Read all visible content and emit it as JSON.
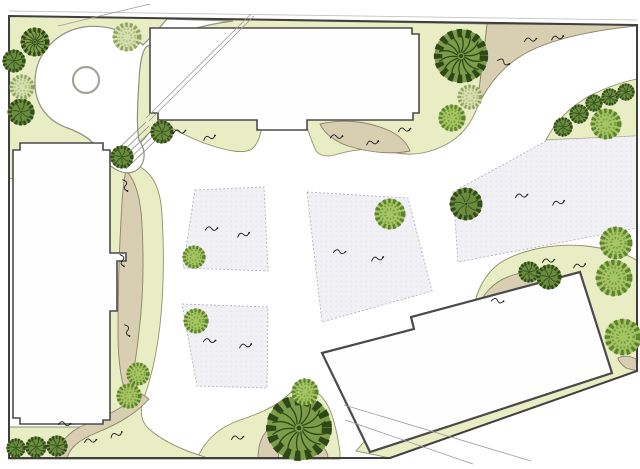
{
  "canvas": {
    "width": 640,
    "height": 469,
    "background": "#ffffff"
  },
  "palette": {
    "lawn": "#e9edc4",
    "lawnStroke": "#8d9168",
    "tan": "#d8ceb1",
    "tanStroke": "#8a8268",
    "parcelFill": "#f0f0f5",
    "parcelStroke": "#b3b3bd",
    "parcelDot": "#d7d7e1",
    "buildingFill": "#fefefe",
    "buildingStroke": "#4a4a4a",
    "boundary": "#3f3f3f",
    "lightLine": "#c4c4c4",
    "thinLine": "#9a9a9a",
    "plazaFill": "#ffffff",
    "plazaStroke": "#8f9180",
    "ringStroke": "#a5a49a",
    "symbol": "#1c1c1c"
  },
  "site": {
    "boundary_points": "9,16 637,25 637,371 390,458 9,458",
    "top_light_line": {
      "x1": 9,
      "y1": 11,
      "x2": 637,
      "y2": 20
    }
  },
  "lawns": [
    {
      "name": "lawn-top",
      "d": "M9,16 L487,24 C484,52 480,80 477,108 C470,127 457,140 441,147 C426,154 409,156 392,152 C374,148 355,149 338,154 C329,157 321,157 316,151 C311,140 308,130 305,122 L305,112 L262,112 C263,128 260,142 252,149 C244,154 230,151 216,147 C199,142 184,135 170,127 L163,122 L149,133 C139,147 125,156 109,161 C79,170 45,172 9,179 Z"
    },
    {
      "name": "lawn-arc-right",
      "d": "M546,140 C557,118 577,100 602,90 C614,85 627,81 637,79 L637,136 Z"
    },
    {
      "name": "lawn-band-right",
      "d": "M472,318 C474,296 483,275 500,263 C522,249 556,243 586,246 C612,249 630,255 637,261 L637,371 L390,458 L356,451 Z"
    },
    {
      "name": "lawn-mound-bottom",
      "d": "M197,459 C205,439 220,427 240,420 C258,414 275,407 287,396 C294,389 301,385 308,387 C317,390 325,399 330,410 C335,422 338,438 340,452 L340,459 Z"
    },
    {
      "name": "lawn-left-cband",
      "d": "M104,163 C119,157 134,161 146,171 C157,181 161,196 162,215 C164,250 164,290 160,325 C157,352 151,378 144,398 C140,410 140,420 148,428 C162,441 182,450 205,457 L205,459 L9,459 L9,427 L104,427 Z"
    }
  ],
  "tan_paths": [
    {
      "name": "tan-sweep-topright",
      "d": "M487,24 C484,52 480,80 477,108 C488,84 505,64 528,52 C557,37 597,30 637,26 L637,25 Z"
    },
    {
      "name": "tan-leaf-under-building",
      "d": "M320,124 C345,118 370,122 390,131 C400,136 407,143 410,151 C390,155 368,152 348,146 C334,141 324,133 320,124 Z"
    },
    {
      "name": "tan-leaf-left",
      "d": "M126,170 C136,181 141,200 142,225 C144,262 143,300 139,332 C136,360 132,382 127,397 C121,382 118,360 118,332 C118,295 119,255 121,220 C122,200 123,184 126,170 Z"
    },
    {
      "name": "tan-ribbon-bottomleft",
      "d": "M55,459 C58,444 68,432 84,425 C105,417 125,407 140,393 L149,399 C136,414 116,425 96,433 C79,440 69,448 67,459 Z"
    },
    {
      "name": "tan-mound-left",
      "d": "M258,459 C258,445 262,434 270,428 C277,433 280,443 279,453 L278,459 Z"
    },
    {
      "name": "tan-mound-right",
      "d": "M310,459 C311,450 315,444 321,446 C326,449 328,454 328,459 Z"
    },
    {
      "name": "tan-corner-wedge",
      "d": "M618,358 C624,355 630,356 636,359 L637,371 L626,368 C621,364 618,361 618,358 Z"
    },
    {
      "name": "tan-crescent-right",
      "d": "M476,313 C481,295 493,282 510,276 C530,269 548,271 560,279 L562,291 C541,283 516,286 499,297 C489,303 481,308 476,313 Z"
    }
  ],
  "plaza": {
    "blob_d": "M167,19 C158,30 150,38 143,45 C128,31 105,24 84,27 C58,31 36,52 35,80 C34,104 47,120 65,127 C82,133 93,140 98,150 C103,160 110,167 119,171 C129,175 138,172 142,164 C146,156 144,147 139,140 C136,125 138,100 139,80 C140,62 142,52 146,47 C165,36 200,25 233,21 Z",
    "ring": {
      "cx": 86,
      "cy": 80,
      "r": 13
    }
  },
  "parcels": [
    {
      "name": "parcel-1",
      "points": "195,190 264,187 268,271 183,268"
    },
    {
      "name": "parcel-2",
      "points": "182,304 268,307 267,388 197,386"
    },
    {
      "name": "parcel-3",
      "points": "307,192 408,198 432,291 322,322"
    },
    {
      "name": "parcel-4",
      "points": "453,192 548,140 637,136 637,228 458,262"
    }
  ],
  "buildings": [
    {
      "name": "building-top",
      "sw": 1.6,
      "points": "150,28 412,28 412,34 419,34 419,113 413,113 413,120 307,120 307,130 257,130 257,120 158,120 158,113 150,113"
    },
    {
      "name": "building-left",
      "sw": 1.6,
      "points": "13,150 20,150 20,143 103,143 103,150 110,150 110,253 126,253 126,261 117,261 117,311 110,311 110,420 103,420 103,424 20,424 20,418 13,418"
    },
    {
      "name": "building-rotated",
      "sw": 2.2,
      "points": "322,353 414,329 411,317 580,272 612,373 370,452"
    }
  ],
  "thin_lines": [
    {
      "name": "construction-line",
      "x1": 251,
      "y1": 14,
      "x2": 146,
      "y2": 118
    },
    {
      "name": "construction-line",
      "x1": 254,
      "y1": 16,
      "x2": 149,
      "y2": 121
    },
    {
      "name": "construction-line",
      "x1": 58,
      "y1": 26,
      "x2": 150,
      "y2": 4
    },
    {
      "name": "path-edge-line",
      "x1": 344,
      "y1": 405,
      "x2": 531,
      "y2": 461
    },
    {
      "name": "path-edge-line",
      "x1": 345,
      "y1": 420,
      "x2": 473,
      "y2": 464
    }
  ],
  "steps": [
    {
      "x1": 146,
      "y1": 122,
      "x2": 114,
      "y2": 153
    },
    {
      "x1": 149,
      "y1": 126,
      "x2": 117,
      "y2": 157
    },
    {
      "x1": 152,
      "y1": 130,
      "x2": 120,
      "y2": 161
    },
    {
      "x1": 155,
      "y1": 134,
      "x2": 123,
      "y2": 165
    },
    {
      "x1": 158,
      "y1": 138,
      "x2": 126,
      "y2": 169
    }
  ],
  "tree_styles": {
    "darkradial": {
      "base": "#7d9c4a",
      "edge": "#2e4917",
      "line": "#2e4917"
    },
    "dark": {
      "base": "#6b8c3e",
      "edge": "#2e4a18",
      "line": "#33531d"
    },
    "bright": {
      "base": "#a6c464",
      "edge": "#5d8230",
      "line": "#76a03e"
    },
    "stipple": {
      "base": "#d6dfad",
      "edge": "#8fa463",
      "line": "#aebd85"
    }
  },
  "trees": [
    {
      "type": "darkradial",
      "x": 461,
      "y": 56,
      "r": 28
    },
    {
      "type": "darkradial",
      "x": 299,
      "y": 428,
      "r": 34
    },
    {
      "type": "darkradial",
      "x": 35,
      "y": 42,
      "r": 15
    },
    {
      "type": "dark",
      "x": 14,
      "y": 61,
      "r": 12
    },
    {
      "type": "dark",
      "x": 21,
      "y": 112,
      "r": 14
    },
    {
      "type": "dark",
      "x": 162,
      "y": 132,
      "r": 12
    },
    {
      "type": "dark",
      "x": 122,
      "y": 157,
      "r": 12
    },
    {
      "type": "dark",
      "x": 466,
      "y": 204,
      "r": 17
    },
    {
      "type": "dark",
      "x": 529,
      "y": 272,
      "r": 11
    },
    {
      "type": "dark",
      "x": 549,
      "y": 277,
      "r": 13
    },
    {
      "type": "dark",
      "x": 563,
      "y": 127,
      "r": 10
    },
    {
      "type": "dark",
      "x": 579,
      "y": 114,
      "r": 10
    },
    {
      "type": "dark",
      "x": 594,
      "y": 103,
      "r": 9
    },
    {
      "type": "dark",
      "x": 610,
      "y": 97,
      "r": 9
    },
    {
      "type": "dark",
      "x": 626,
      "y": 92,
      "r": 9
    },
    {
      "type": "dark",
      "x": 16,
      "y": 448,
      "r": 10
    },
    {
      "type": "dark",
      "x": 36,
      "y": 447,
      "r": 11
    },
    {
      "type": "dark",
      "x": 57,
      "y": 446,
      "r": 11
    },
    {
      "type": "stipple",
      "x": 470,
      "y": 97,
      "r": 13
    },
    {
      "type": "stipple",
      "x": 127,
      "y": 37,
      "r": 15
    },
    {
      "type": "stipple",
      "x": 22,
      "y": 87,
      "r": 13
    },
    {
      "type": "bright",
      "x": 452,
      "y": 118,
      "r": 14
    },
    {
      "type": "bright",
      "x": 194,
      "y": 257,
      "r": 12
    },
    {
      "type": "bright",
      "x": 196,
      "y": 321,
      "r": 13
    },
    {
      "type": "bright",
      "x": 390,
      "y": 214,
      "r": 16
    },
    {
      "type": "bright",
      "x": 606,
      "y": 124,
      "r": 16
    },
    {
      "type": "bright",
      "x": 616,
      "y": 243,
      "r": 17
    },
    {
      "type": "bright",
      "x": 614,
      "y": 278,
      "r": 19
    },
    {
      "type": "bright",
      "x": 623,
      "y": 337,
      "r": 19
    },
    {
      "type": "bright",
      "x": 138,
      "y": 374,
      "r": 12
    },
    {
      "type": "bright",
      "x": 129,
      "y": 396,
      "r": 13
    },
    {
      "type": "bright",
      "x": 305,
      "y": 392,
      "r": 14
    }
  ],
  "shrub_symbols": [
    {
      "x": 179,
      "y": 132,
      "rot": 0
    },
    {
      "x": 209,
      "y": 138,
      "rot": -10
    },
    {
      "x": 336,
      "y": 137,
      "rot": 5
    },
    {
      "x": 372,
      "y": 143,
      "rot": -5
    },
    {
      "x": 404,
      "y": 130,
      "rot": 0
    },
    {
      "x": 530,
      "y": 40,
      "rot": 0
    },
    {
      "x": 557,
      "y": 38,
      "rot": -5
    },
    {
      "x": 503,
      "y": 62,
      "rot": 30
    },
    {
      "x": 521,
      "y": 196,
      "rot": 0
    },
    {
      "x": 558,
      "y": 203,
      "rot": -8
    },
    {
      "x": 339,
      "y": 252,
      "rot": 10
    },
    {
      "x": 377,
      "y": 259,
      "rot": -5
    },
    {
      "x": 211,
      "y": 229,
      "rot": 5
    },
    {
      "x": 243,
      "y": 235,
      "rot": -8
    },
    {
      "x": 209,
      "y": 341,
      "rot": 8
    },
    {
      "x": 245,
      "y": 346,
      "rot": -5
    },
    {
      "x": 548,
      "y": 261,
      "rot": 0
    },
    {
      "x": 579,
      "y": 266,
      "rot": -5
    },
    {
      "x": 497,
      "y": 301,
      "rot": 15
    },
    {
      "x": 125,
      "y": 185,
      "rot": 80
    },
    {
      "x": 122,
      "y": 260,
      "rot": 85
    },
    {
      "x": 127,
      "y": 330,
      "rot": 80
    },
    {
      "x": 90,
      "y": 441,
      "rot": 0
    },
    {
      "x": 116,
      "y": 435,
      "rot": -15
    },
    {
      "x": 64,
      "y": 424,
      "rot": 10
    },
    {
      "x": 237,
      "y": 438,
      "rot": 0
    }
  ],
  "symbol_glyph": {
    "d": "M-5.5,1.5 C-3.5,-2.5 -1.5,-3 0.5,-0.5 C2.5,2 4.5,1.5 6,-1"
  }
}
